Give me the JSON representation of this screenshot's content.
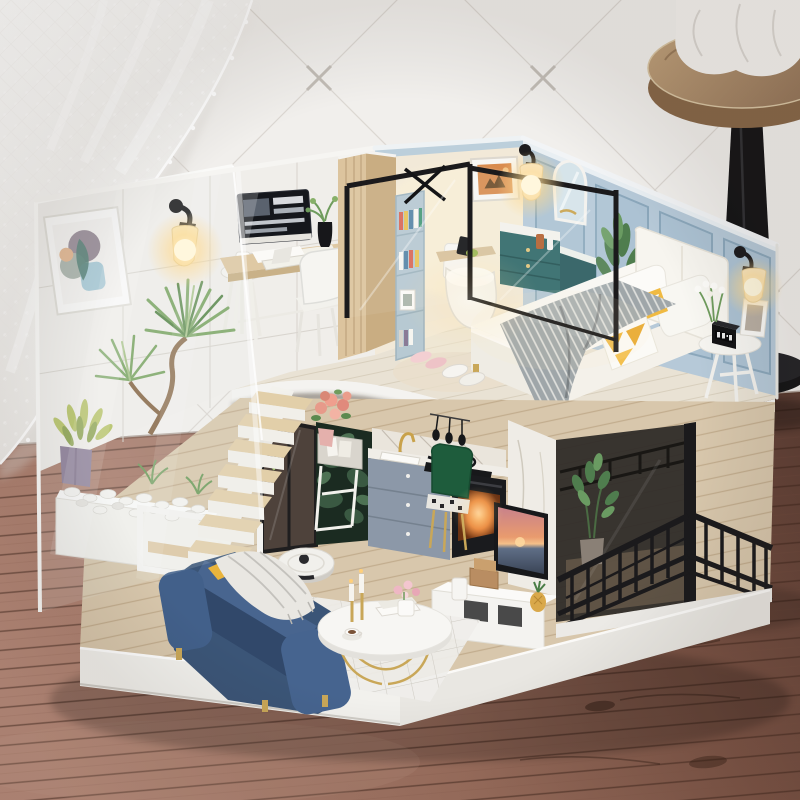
{
  "scene": {
    "type": "photograph",
    "subject": "DIY miniature dollhouse diorama of a two-storey loft apartment",
    "setting": "standing on a wooden plank table, white quilted wall with diagonal stitching behind, white lace curtain at upper left, round wooden bar stool with black leg at upper right",
    "upper_floor": "home office with computer desk, white chair and stool; glass-partitioned bathroom with teal vanity, toilet and arched mirror; bedroom with white bed, grey knit throw, yellow accent pillows, tripod nightstand, glowing wall lamps on blue panelled walls",
    "lower_floor": "living room with navy sofa, round gold-leg coffee table, robot vacuum, white grid rug; kitchen with grey cabinets, gold faucet, cooktop and glowing oven; dark botanical accent wall with flower stand; marble TV panel with sunset on screen; black-railed balcony with smoked glass; acrylic-walled rock garden with plants and floating staircase"
  },
  "objects": [
    "lace-curtain",
    "quilted-wall",
    "bar-stool",
    "white-cloth",
    "wood-table",
    "abstract-art-frame",
    "office-wall-lamp",
    "computer-monitor",
    "keyboard",
    "desk",
    "office-chair",
    "office-stool",
    "mug",
    "black-vase",
    "wood-partition",
    "bookshelf",
    "glass-partition",
    "safari-art",
    "bath-wall-lamp",
    "arched-mirror",
    "teal-vanity",
    "teal-cabinet",
    "toilet",
    "bath-plant",
    "bed",
    "headboard",
    "grey-knit-blanket",
    "yellow-triangle-pillow",
    "white-pillows",
    "slippers",
    "tripod-nightstand",
    "digital-clock",
    "photo-frame",
    "bedroom-wall-lamp",
    "kitchen-counter",
    "gold-faucet",
    "cooktop-pan",
    "hanging-utensils",
    "oven",
    "green-velvet-chair",
    "botanical-wall",
    "flower-stand",
    "peach-roses",
    "tv-marble-panel",
    "television",
    "tv-stand",
    "wooden-box",
    "pineapple",
    "balcony-railing",
    "smoked-glass",
    "balcony-plant",
    "navy-sofa",
    "throw-blanket",
    "coffee-table",
    "candlesticks",
    "teacup",
    "robot-vacuum",
    "grid-rug",
    "rock-garden",
    "white-pebbles",
    "yucca-plant",
    "purple-pot-plant",
    "floating-stairs",
    "white-console-frame",
    "acrylic-wall",
    "dollhouse-base"
  ],
  "palette": {
    "wall": "#f1efec",
    "wall_line": "#dbd7d2",
    "wall_stitch": "#c2bdb6",
    "curtain": "#fdfdfc",
    "table_light": "#b78a7a",
    "table_mid": "#9c6f5e",
    "table_dark": "#5e3e34",
    "plank_line": "#42291f",
    "stool_wood": "#b49a76",
    "stool_leg": "#141416",
    "stool_cloth": "#f4f2ef",
    "base_white": "#f2f1ed",
    "base_shade": "#e9e7e2",
    "tile_wall": "#f0eeea",
    "tile_line": "#d7d3cd",
    "bath_wall": "#f2e9d8",
    "crown_blue": "#bccfdb",
    "blue_wall": "#b6c9d8",
    "blue_panel": "#acc2d3",
    "panel_line": "#8ba7bb",
    "deck_wood": "#e9e2d4",
    "deck_plank": "#d5cbb9",
    "fascia": "#f4f3f0",
    "floor_wood": "#d8c7ac",
    "floor_plank": "#c0aa8b",
    "partition_wood": "#dcc49e",
    "partition_side": "#c9ad82",
    "bookshelf": "#b7c9d2",
    "vanity_teal": "#2e6767",
    "cabinet_teal": "#27585c",
    "toilet": "#f7f6f3",
    "headboard": "#f7f5ef",
    "mattress": "#faf8f3",
    "bed_base": "#efece4",
    "blanket": "#9fa6a9",
    "blanket_stripe": "#e6e6e2",
    "pillow_yellow": "#f0b63a",
    "desk_wood": "#dfc9a4",
    "monitor": "#15171c",
    "chair_white": "#f6f5f1",
    "cabinet_gray": "#8c98a8",
    "oven": "#1a1b1e",
    "botanical": "#1b2b21",
    "leaf_dark": "#3c5c44",
    "chair_green": "#1e5c3c",
    "gold": "#c9a758",
    "faucet_gold": "#c9a24b",
    "tv_panel": "#efece6",
    "tv_frame": "#17181b",
    "tv_stand": "#f4f3f0",
    "wood_box": "#b98d62",
    "pineapple": "#d9a84a",
    "glass_smoke": "#2e2a27",
    "railing": "#1b1a1c",
    "balcony_floor": "#a98e6f",
    "sofa": "#3b5577",
    "sofa_dark": "#31486a",
    "sofa_light": "#48658f",
    "throw": "#e9e7e2",
    "coffee_table": "#f7f6f3",
    "vacuum": "#f1f0ec",
    "rug": "#efeeea",
    "rug_line": "#cfccc4",
    "plant": "#7fa868",
    "plant_dark": "#5c8a4f",
    "plant_light": "#a9c48b",
    "trunk": "#8a6a4a",
    "pot_purple": "#8a7b96",
    "rose": "#e79a8a",
    "plant_yellow": "#b5c264",
    "stair_wood": "#e2cfa9",
    "white_frame": "#f4f3f0",
    "pebble": "#f2f1ed",
    "glow": "#ffd98d",
    "glow_core": "#fff6da",
    "oven_glow": "#e8833a",
    "screen_sky": "#e99b6e",
    "screen_pink": "#c8818b",
    "screen_sea": "#5f6e86",
    "acrylic_edge": "#fafaf8",
    "dark_door": "#4e423b"
  }
}
